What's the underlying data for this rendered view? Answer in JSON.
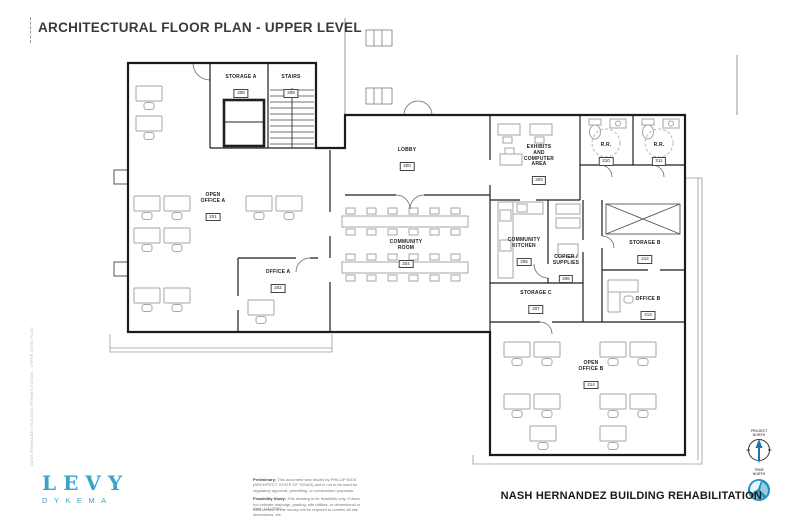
{
  "title": "ARCHITECTURAL FLOOR PLAN - UPPER LEVEL",
  "footer": {
    "project_title": "NASH HERNANDEZ BUILDING REHABILITATION",
    "logo_line1": "LEVY",
    "logo_line2": "DYKEMA",
    "brand_color": "#3ba4c9",
    "date_line": "Date:    1/31/2020",
    "notes": {
      "preliminary_label": "Preliminary:",
      "preliminary_text": " This document was issued by PHILLIP NICK (ARCHITECT, STATE OF TEXAS) and is not to be used for regulatory approval, permitting, or construction purposes.",
      "feasibility_label": "Feasibility Study:",
      "feasibility_text": " This drawing is for feasibility only. It does not indicate drainage, grading, site utilities, or dimensional or ADA control. A site survey will be required to confirm all site dimensions, etc."
    },
    "compass": {
      "project_north": "PROJECT\nNORTH",
      "true_north": "TRUE\nNORTH",
      "arrow_color": "#1b74b4",
      "logo_color": "#1e8fbf"
    }
  },
  "stamp_text": "NASH HERNANDEZ BUILDING REHABILITATION - UPPER LEVEL PLAN",
  "rooms": [
    {
      "name": "STORAGE A",
      "number": "208"
    },
    {
      "name": "STAIRS",
      "number": "209"
    },
    {
      "name": "OPEN\nOFFICE A",
      "number": "201"
    },
    {
      "name": "OFFICE A",
      "number": "202"
    },
    {
      "name": "LOBBY",
      "number": "200"
    },
    {
      "name": "COMMUNITY\nROOM",
      "number": "204"
    },
    {
      "name": "EXHIBITS\nAND\nCOMPUTER\nAREA",
      "number": "203"
    },
    {
      "name": "R.R.",
      "number": "210"
    },
    {
      "name": "R.R.",
      "number": "211"
    },
    {
      "name": "COMMUNITY\nKITCHEN",
      "number": "205"
    },
    {
      "name": "COPIER /\nSUPPLIES",
      "number": "206"
    },
    {
      "name": "STORAGE C",
      "number": "207"
    },
    {
      "name": "STORAGE B",
      "number": "212"
    },
    {
      "name": "OFFICE B",
      "number": "213"
    },
    {
      "name": "OPEN\nOFFICE B",
      "number": "214"
    }
  ]
}
